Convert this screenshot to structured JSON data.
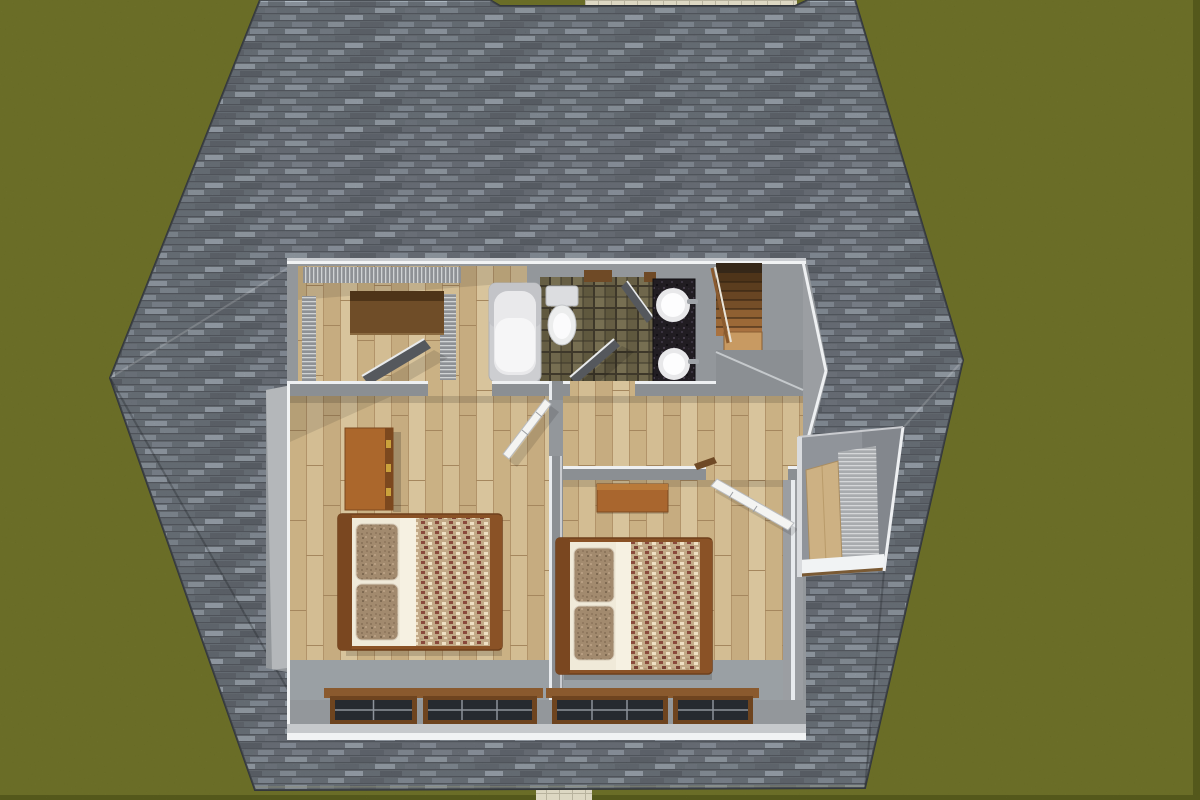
{
  "scene": {
    "title": "top-down-3d-cutaway-floor-plan-render",
    "view": "overhead dollhouse cutaway of an upper floor surrounded by a hip shingle roof and lawn",
    "rooms": [
      {
        "name": "closet-room",
        "features": [
          "wire-shelving",
          "wood-shelf",
          "dark-open-door"
        ]
      },
      {
        "name": "bathroom",
        "features": [
          "bathtub",
          "toilet",
          "mosaic-tile-floor",
          "black-vanity",
          "two-round-sinks",
          "two-dark-doors"
        ]
      },
      {
        "name": "staircase",
        "features": [
          "wood-treads",
          "newel-landing",
          "railing"
        ]
      },
      {
        "name": "hallway",
        "features": [
          "wood-floor"
        ]
      },
      {
        "name": "bedroom-left",
        "features": [
          "double-bed",
          "dresser",
          "two-windows",
          "white-door"
        ]
      },
      {
        "name": "bedroom-right",
        "features": [
          "double-bed",
          "desk",
          "two-windows",
          "white-door"
        ]
      },
      {
        "name": "dormer-window-nook",
        "features": [
          "wood-panel",
          "blind-screen",
          "white-sill"
        ]
      }
    ],
    "window_count": 4,
    "bed_count": 2,
    "sink_count": 2
  },
  "palette": {
    "grass": "#676a2b",
    "grass_dark": "#43460f",
    "grass_light": "#a3a649",
    "walkway": "#ddd8c3",
    "shingle_base": "#6e747c",
    "wall": "#93979b",
    "wall_light": "#b4b7ba",
    "wall_cut": "#f1f3f4",
    "wood_floor": "#d3bd93",
    "tub_shell": "#cdced1",
    "tub_inner": "#f6f6f7",
    "toilet": "#eceded",
    "vanity": "#211d22",
    "sink": "#fdfdfe",
    "tile_floor": "#6b6349",
    "door_dark": "#55585d",
    "door_white": "#f4f4f2",
    "bed_frame": "#8a5226",
    "mattress": "#f0ead9",
    "comforter": "#c2a987",
    "pillow": "#a28a6e",
    "window_glass": "#262a30",
    "window_frame": "#6e441f",
    "sill_brown": "#8a5a2e",
    "stair_wood": "#8f6032",
    "newel": "#c89a62",
    "dresser": "#ab672c",
    "desk": "#a9662e",
    "dormer_wood": "#cdb183",
    "shelf_brown": "#6f4d28"
  }
}
